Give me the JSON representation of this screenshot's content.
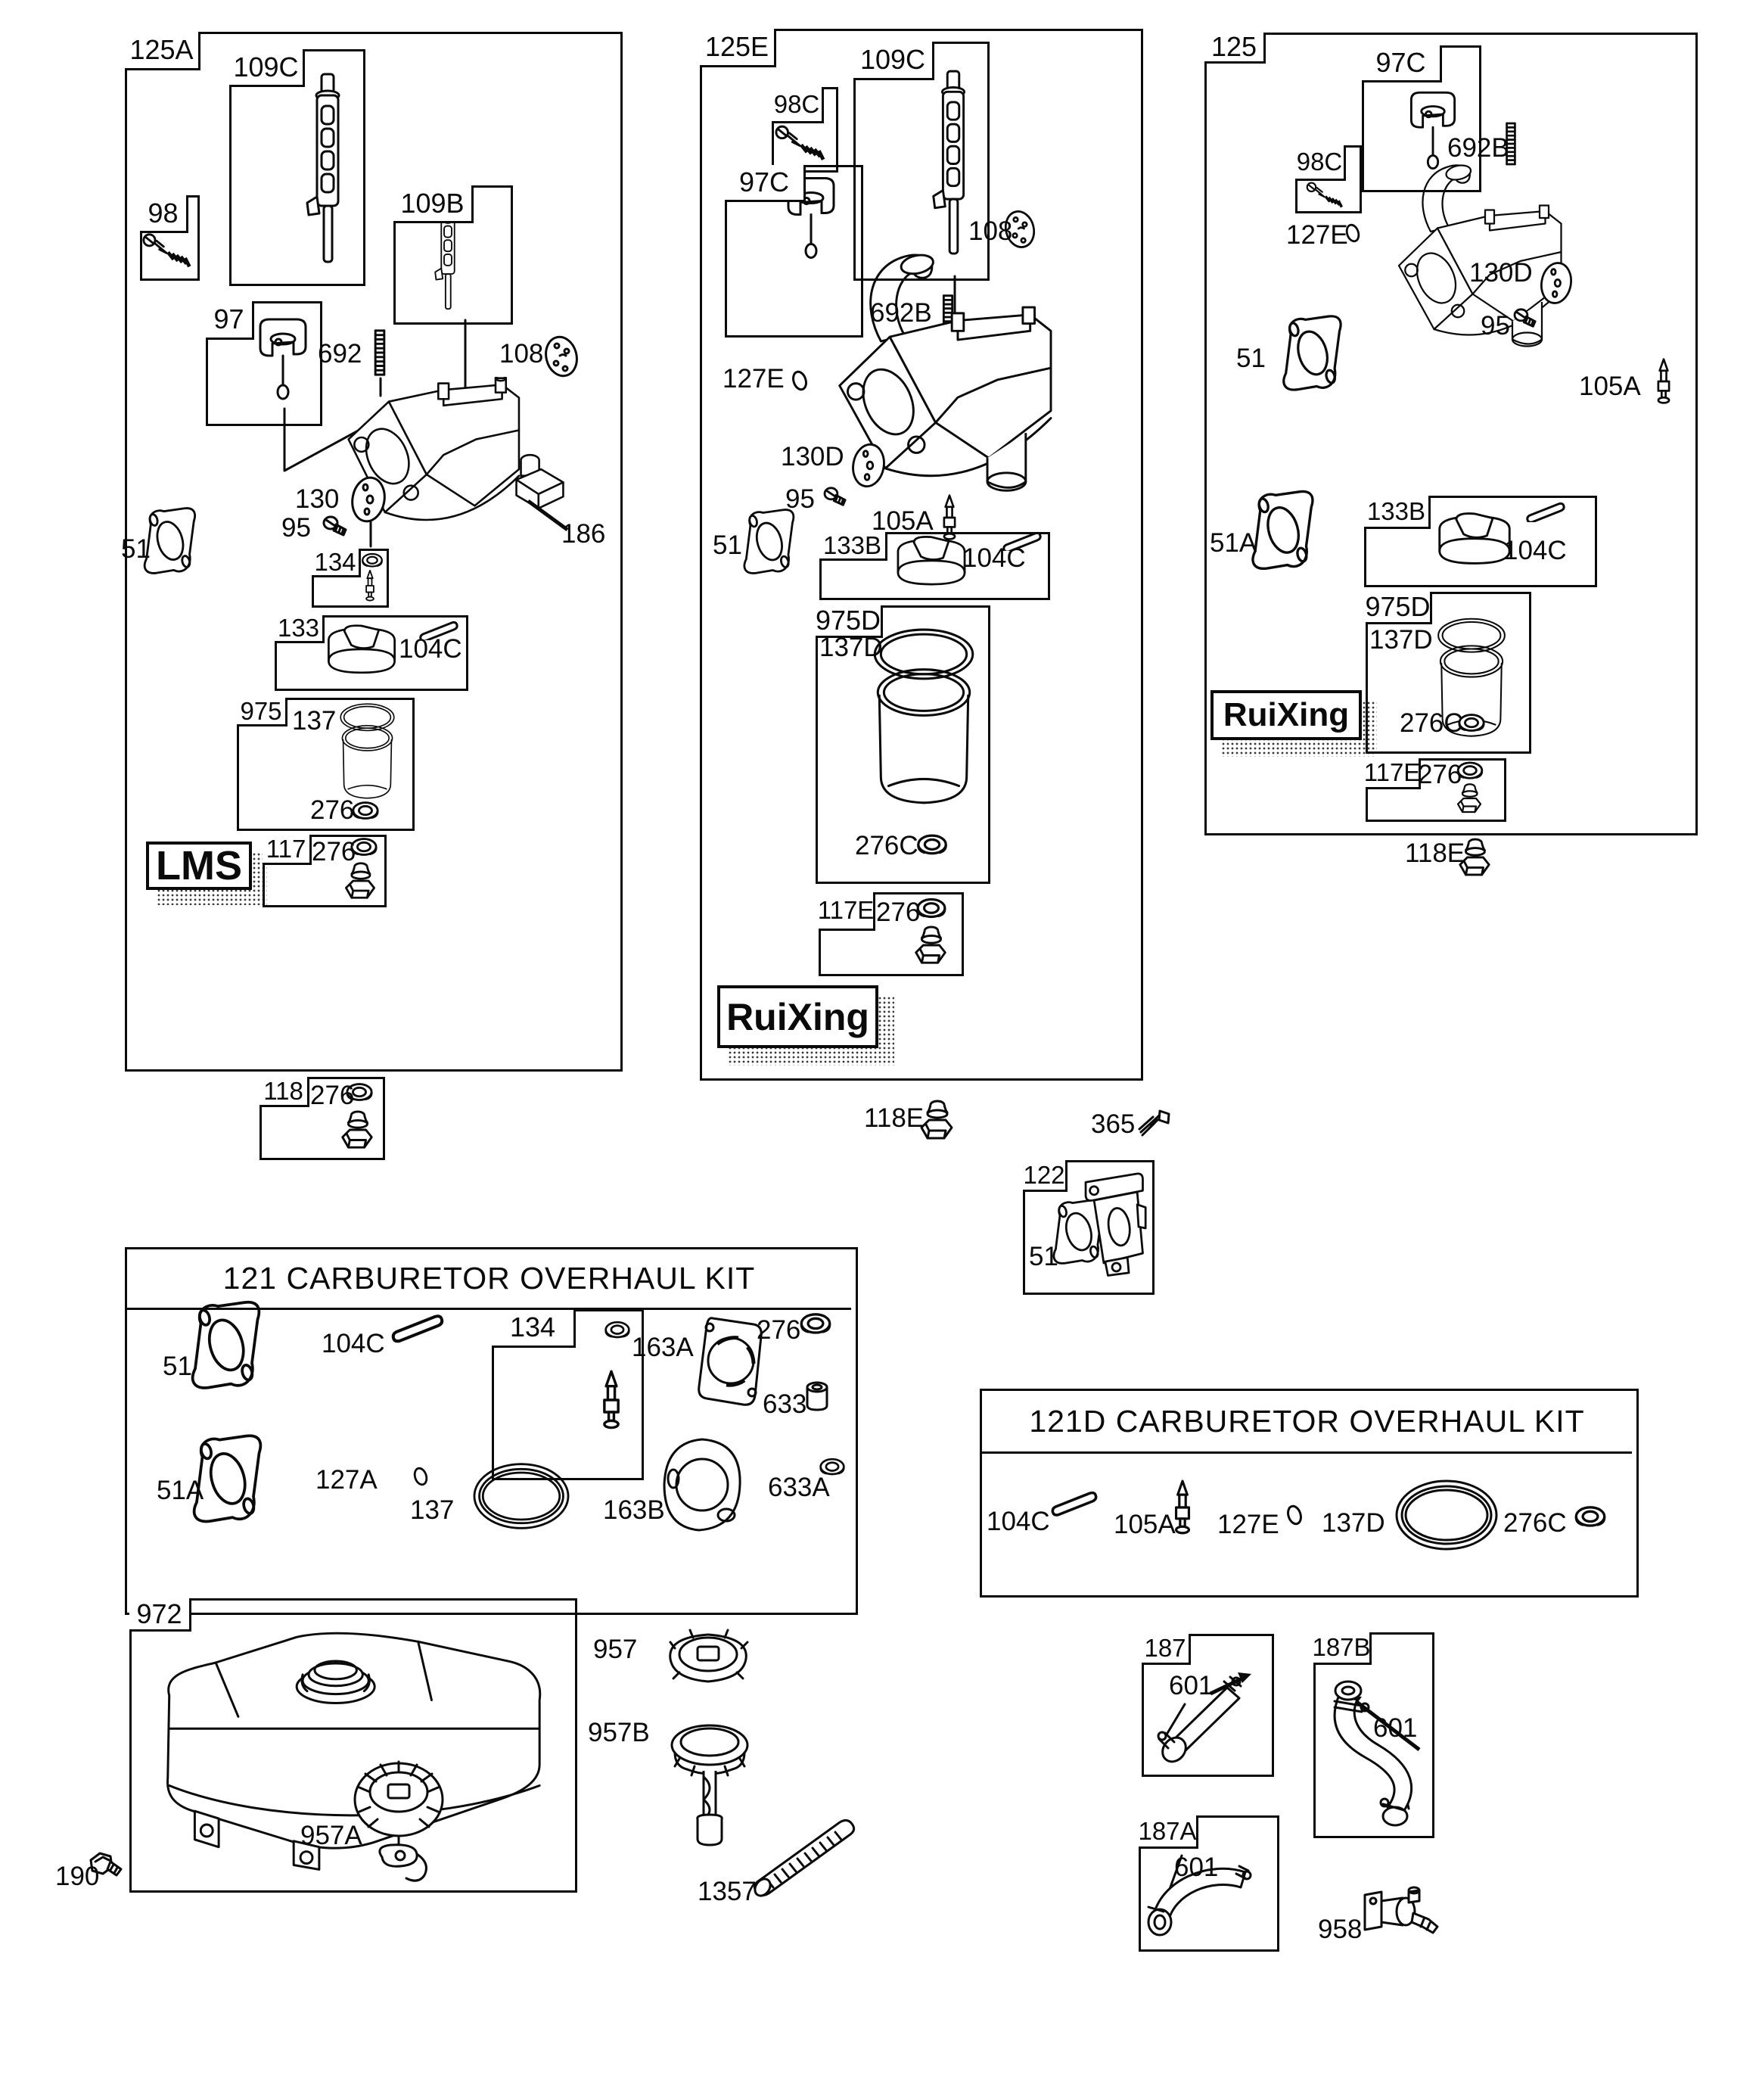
{
  "diagram": {
    "type": "engine-carburetor-parts-diagram",
    "brand_logos": {
      "lms": "LMS",
      "ruixing": "RuiXing"
    },
    "kit_titles": {
      "k121": "121 CARBURETOR OVERHAUL KIT",
      "k121d": "121D CARBURETOR OVERHAUL KIT"
    },
    "labels": {
      "g1_tag": "125A",
      "g1_109C": "109C",
      "g1_98": "98",
      "g1_109B": "109B",
      "g1_97": "97",
      "g1_692": "692",
      "g1_108": "108",
      "g1_130": "130",
      "g1_95": "95",
      "g1_186": "186",
      "g1_51": "51",
      "g1_134": "134",
      "g1_133": "133",
      "g1_104C": "104C",
      "g1_975": "975",
      "g1_137": "137",
      "g1_276_bowl": "276",
      "g1_117": "117",
      "g1_276_117": "276",
      "g1_118": "118",
      "g1_276_118": "276",
      "g2_tag": "125E",
      "g2_109C": "109C",
      "g2_98C": "98C",
      "g2_97C": "97C",
      "g2_692B": "692B",
      "g2_108": "108",
      "g2_127E": "127E",
      "g2_130D": "130D",
      "g2_95": "95",
      "g2_105A": "105A",
      "g2_51": "51",
      "g2_133B": "133B",
      "g2_104C": "104C",
      "g2_975D": "975D",
      "g2_137D": "137D",
      "g2_276C": "276C",
      "g2_117E": "117E",
      "g2_276": "276",
      "g2_118E": "118E",
      "g3_tag": "125",
      "g3_97C": "97C",
      "g3_98C": "98C",
      "g3_692B": "692B",
      "g3_127E": "127E",
      "g3_130D": "130D",
      "g3_95": "95",
      "g3_51": "51",
      "g3_105A": "105A",
      "g3_51A": "51A",
      "g3_133B": "133B",
      "g3_104C": "104C",
      "g3_975D": "975D",
      "g3_137D": "137D",
      "g3_276C": "276C",
      "g3_117E": "117E",
      "g3_276": "276",
      "g3_118E": "118E",
      "m_365": "365",
      "m_122": "122",
      "m_122_51": "51",
      "k1_51": "51",
      "k1_104C": "104C",
      "k1_134": "134",
      "k1_163A": "163A",
      "k1_276": "276",
      "k1_633": "633",
      "k1_51A": "51A",
      "k1_127A": "127A",
      "k1_137": "137",
      "k1_163B": "163B",
      "k1_633A": "633A",
      "k2_104C": "104C",
      "k2_105A": "105A",
      "k2_127E": "127E",
      "k2_137D": "137D",
      "k2_276C": "276C",
      "b_972": "972",
      "b_957": "957",
      "b_957A": "957A",
      "b_957B": "957B",
      "b_190": "190",
      "b_1357": "1357",
      "b_187": "187",
      "b_187_601": "601",
      "b_187A": "187A",
      "b_187A_601": "601",
      "b_187B": "187B",
      "b_187B_601": "601",
      "b_958": "958"
    },
    "colors": {
      "ink": "#0a0a0a",
      "paper": "#ffffff"
    }
  }
}
